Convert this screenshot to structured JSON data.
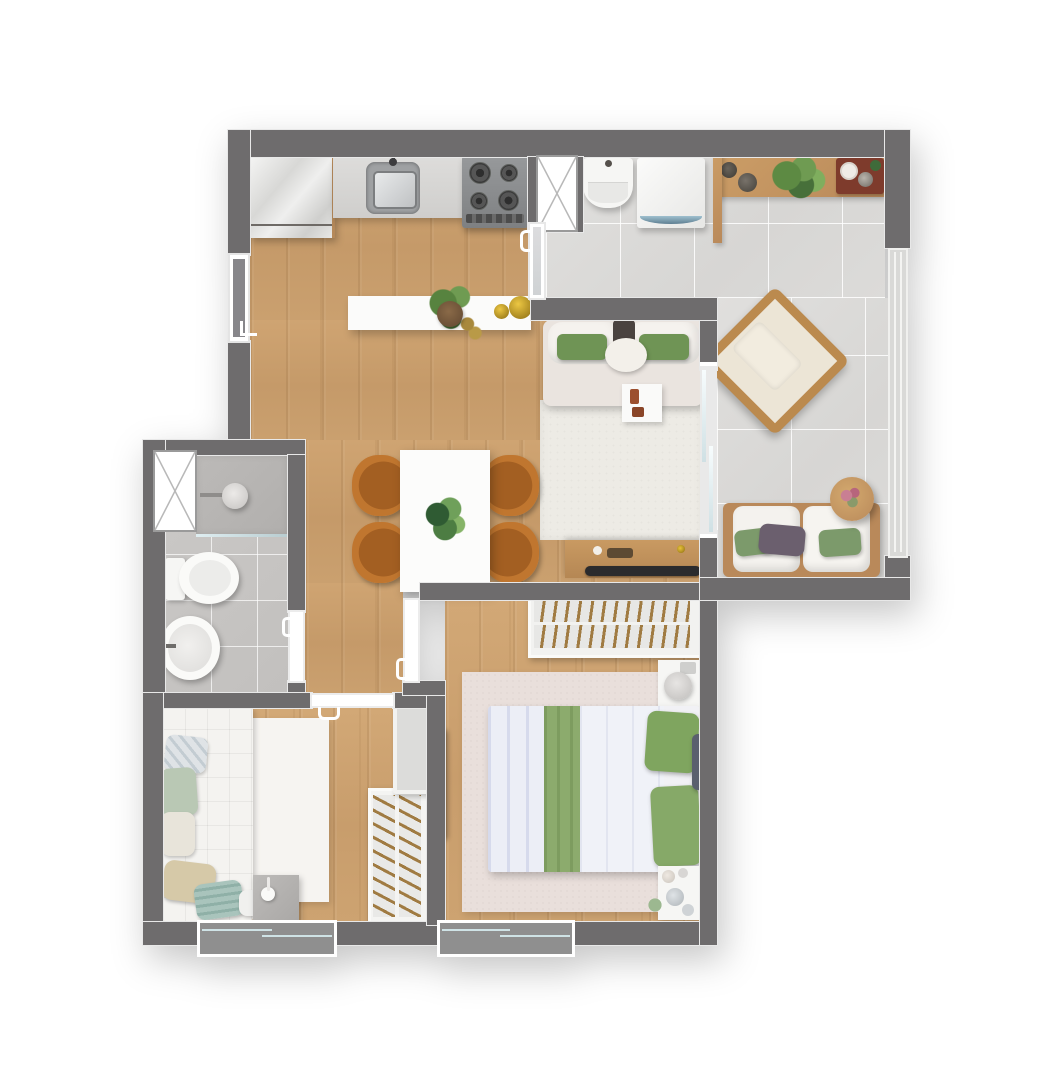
{
  "plan": {
    "title": "Apartment floor plan - 2 bedrooms, top view render",
    "palette": {
      "wall": "#6e6c6d",
      "wood_floor": "#c89d6c",
      "tile_floor": "#dbdad8",
      "bath_tile": "#c6c4c2",
      "accent_green": "#7da361",
      "chair_caramel": "#c0762f",
      "furniture_wood": "#c0925e",
      "rug_living": "#edebe5",
      "rug_bedroom2": "#e9dfdb",
      "tv_black": "#2e2e30",
      "glass": "#dfeef1"
    },
    "rooms": [
      {
        "name": "kitchen"
      },
      {
        "name": "living-dining"
      },
      {
        "name": "service-balcony"
      },
      {
        "name": "bathroom"
      },
      {
        "name": "hallway"
      },
      {
        "name": "bedroom-1"
      },
      {
        "name": "bedroom-2"
      }
    ],
    "labels": {
      "refrigerator": "refrigerator",
      "counter_sink": "kitchen counter with sink",
      "cooktop": "gas cooktop 4 burners",
      "breakfast_bar": "breakfast bar with plant and bowls",
      "shaft_kitchen": "ventilation shaft",
      "shaft_bath": "ventilation shaft",
      "laundry_tank": "laundry tank",
      "washer": "washing machine",
      "shelf": "wall shelf with vases and plant",
      "lounge_chair": "lounge chair",
      "balcony_sofa": "balcony sofa with pillows",
      "round_table": "round side table with flowers",
      "glass_railing": "glass railing",
      "sofa_bed": "sofa with green pillows",
      "side_table": "side tray table",
      "living_rug": "living room rug",
      "tv_console": "tv console",
      "tv": "television",
      "dining_table": "dining table with plant",
      "dining_chair": "dining chair",
      "shower": "shower with glass partition",
      "toilet": "toilet",
      "washbasin": "round washbasin",
      "single_bed": "single bed with pillows",
      "bedroom1_rug": "bedroom rug",
      "desk": "desk with lamp",
      "wardrobe1": "open wardrobe with hangers",
      "cabinet1": "storage cabinet",
      "double_bed": "double bed with green runner and pillows",
      "nightstand_lamp": "nightstand with lamp",
      "nightstand": "nightstand with accessories",
      "wardrobe2": "open wardrobe with hangers",
      "wall_tv": "wall mounted tv",
      "window": "sliding window",
      "entry_door": "entry door",
      "service_door": "kitchen to service door",
      "sliding_door": "living to balcony sliding door",
      "bathroom_door": "bathroom door",
      "bedroom1_door": "bedroom 1 door",
      "bedroom2_door": "bedroom 2 door"
    },
    "counts": {
      "bedrooms": 2,
      "bathrooms": 1,
      "windows": 2,
      "doors": 6
    }
  }
}
